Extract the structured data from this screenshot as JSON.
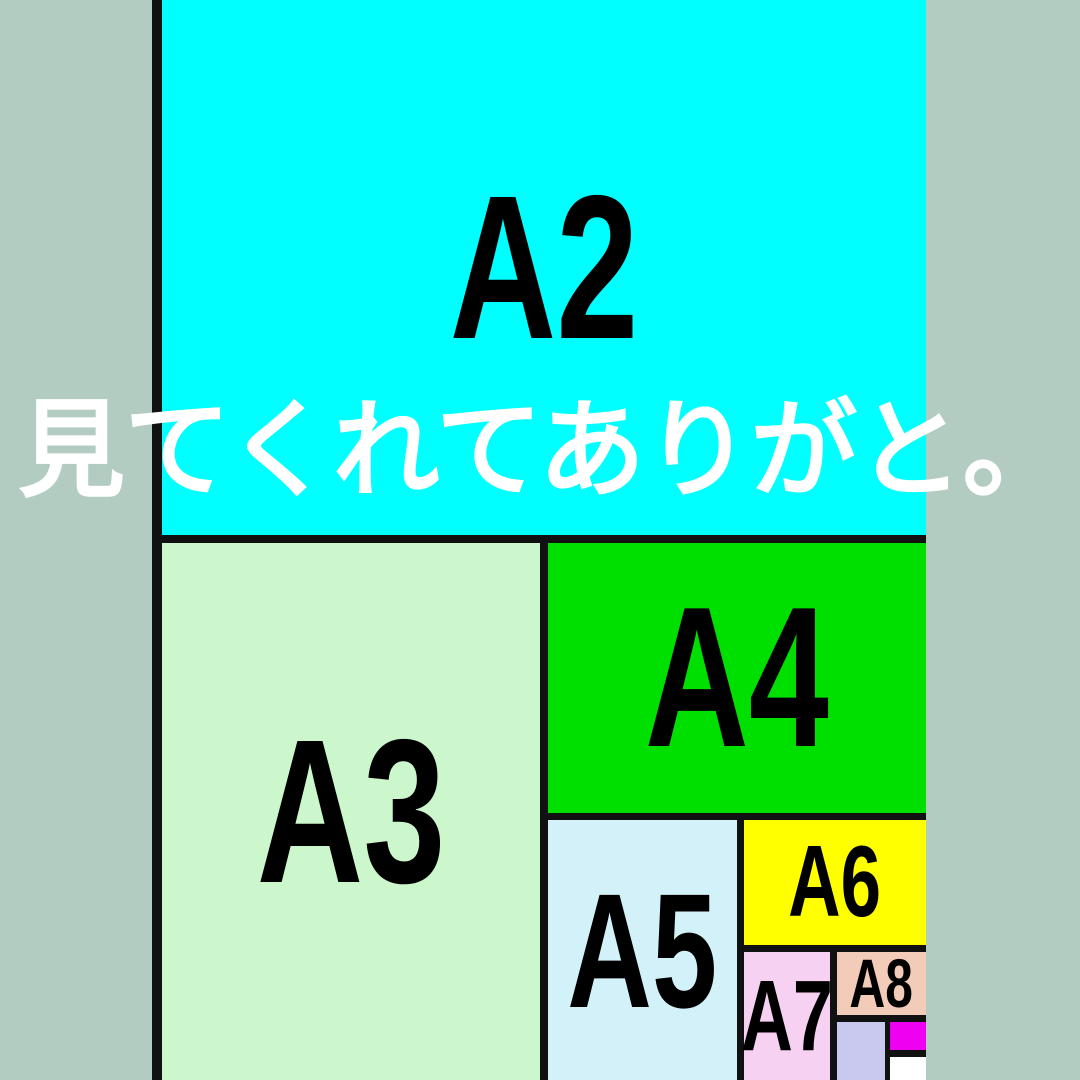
{
  "background_color": "#b3ccc2",
  "border_color": "#111111",
  "caption": {
    "text": "見てくれてありがと。",
    "color": "#ffffff"
  },
  "diagram": {
    "description": "Nested A-series paper size comparison chart, cropped at top, bottom and right edges",
    "regions": [
      {
        "id": "a2",
        "label": "A2",
        "color": "#00ffff"
      },
      {
        "id": "a3",
        "label": "A3",
        "color": "#ccf7cc"
      },
      {
        "id": "a4",
        "label": "A4",
        "color": "#00e000"
      },
      {
        "id": "a5",
        "label": "A5",
        "color": "#d2f1f8"
      },
      {
        "id": "a6",
        "label": "A6",
        "color": "#ffff00"
      },
      {
        "id": "a7",
        "label": "A7",
        "color": "#f6d1f2"
      },
      {
        "id": "a8",
        "label": "A8",
        "color": "#f2cbb9"
      },
      {
        "id": "a9",
        "label": "",
        "color": "#c9c9ef"
      },
      {
        "id": "a10",
        "label": "",
        "color": "#f000f0"
      },
      {
        "id": "a11",
        "label": "",
        "color": "#ffffff"
      }
    ]
  }
}
